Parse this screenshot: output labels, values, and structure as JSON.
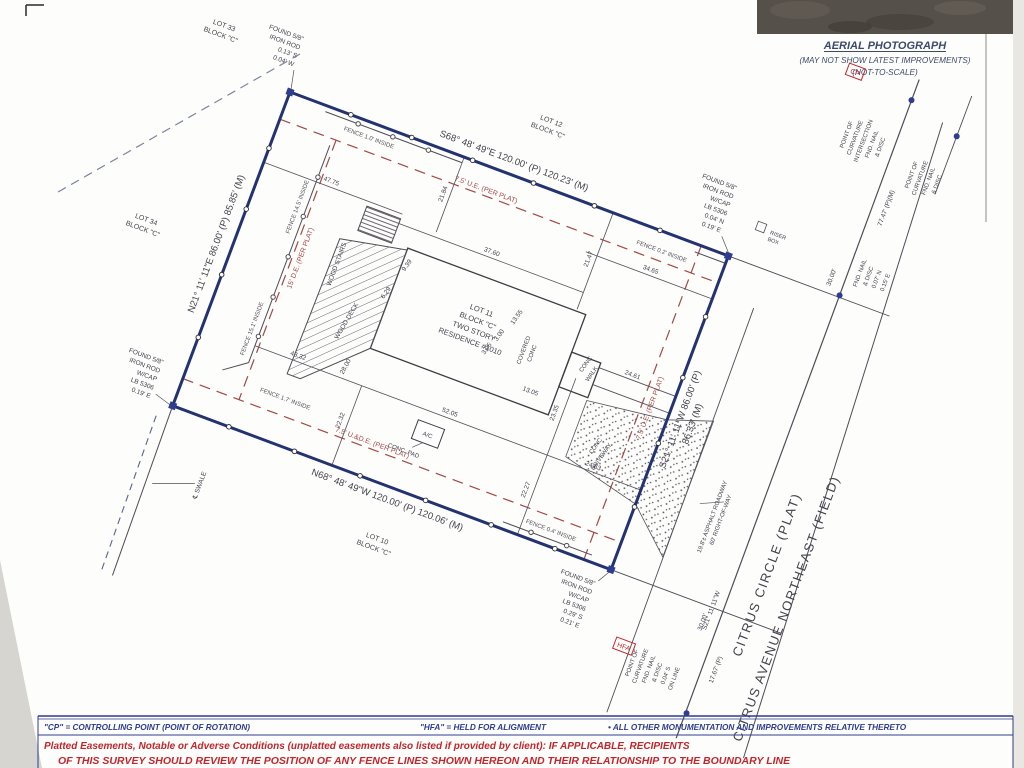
{
  "aerial": {
    "title": "AERIAL PHOTOGRAPH",
    "sub1": "(MAY NOT SHOW LATEST IMPROVEMENTS)",
    "sub2": "(NOT-TO-SCALE)"
  },
  "notes": {
    "l1a": "\"CP\" = CONTROLLING POINT (POINT OF ROTATION)",
    "l1b": "\"HFA\" = HELD FOR ALIGNMENT",
    "l1c": "•    ALL OTHER MONUMENTATION AND IMPROVEMENTS RELATIVE THERETO",
    "l2": "Platted Easements, Notable or Adverse Conditions (unplatted easements also listed if provided by client): IF APPLICABLE, RECIPIENTS",
    "l3": "OF THIS SURVEY SHOULD REVIEW THE POSITION OF ANY FENCE LINES SHOWN HEREON AND THEIR RELATIONSHIP TO THE BOUNDARY LINE"
  },
  "bearings": {
    "north": "S68° 48' 49\"E   120.00' (P) 120.23' (M)",
    "south": "N68° 48' 49\"W   120.00' (P) 120.06' (M)",
    "west": "N21° 11' 11\"E   86.00' (P) 85.85' (M)",
    "east_p": "S21° 11' 11\"W   86.00' (P)",
    "east_m": "86.33' (M)",
    "road": "S21° 11' 11\"W"
  },
  "lots": {
    "lot11_1": "LOT 11",
    "lot11_2": "BLOCK \"C\"",
    "lot11_3": "TWO STORY",
    "lot11_4": "RESIDENCE #1010",
    "lot12_1": "LOT 12",
    "lot12_2": "BLOCK \"C\"",
    "lot33_1": "LOT 33",
    "lot33_2": "BLOCK \"C\"",
    "lot34_1": "LOT 34",
    "lot34_2": "BLOCK \"C\"",
    "lot10_1": "LOT 10",
    "lot10_2": "BLOCK \"C\""
  },
  "streets": {
    "s1": "CITRUS CIRCLE (PLAT)",
    "s2": "CITRUS AVENUE NORTHEAST (FIELD)",
    "asphalt": "19.8'± ASPHALT ROADWAY",
    "row": "60' RIGHT-OF-WAY"
  },
  "easements": {
    "top": "7.5' U.E. (PER PLAT)",
    "left": "15' D.E. (PER PLAT)",
    "right": "7.5' U.E. (PER PLAT)",
    "bottom": "7.5' U.&D.E. (PER PLAT)"
  },
  "fences": {
    "f1": "FENCE 1.0' INSIDE",
    "f2": "FENCE 14.5' INSIDE",
    "f3": "FENCE 15.1' INSIDE",
    "f4": "FENCE 1.7' INSIDE",
    "f5": "FENCE 0.2' INSIDE",
    "f6": "FENCE 0.4' INSIDE"
  },
  "features": {
    "wood_deck": "WOOD DECK",
    "wood_stairs": "WOOD STAIRS",
    "covered1": "COVERED",
    "covered2": "CONC",
    "walk1": "CONC",
    "walk2": "WALK",
    "drive1": "CONC",
    "drive2": "DRIVEWAY",
    "ac": "A/C",
    "conc_pad": "CONC. PAD",
    "swale": "℄ SWALE",
    "riser1": "RISER",
    "riser2": "BOX"
  },
  "flags": {
    "cp": "CP",
    "hfa": "HFA"
  },
  "monuments": {
    "tl": [
      "FOUND 5/8\"",
      "IRON ROD",
      "0.13' S",
      "0.04' W"
    ],
    "tr": [
      "FOUND 5/8\"",
      "IRON ROD",
      "W/CAP",
      "LB 5306",
      "0.04' N",
      "0.19' E"
    ],
    "bl": [
      "FOUND 5/8\"",
      "IRON ROD",
      "W/CAP",
      "LB 5306",
      "0.19' E"
    ],
    "br": [
      "FOUND 5/8\"",
      "IRON ROD",
      "W/CAP",
      "LB 5306",
      "0.29' S",
      "0.21' E"
    ],
    "nail_top": [
      "FND. NAIL",
      "& DISC",
      "0.07' N",
      "0.15' E"
    ],
    "pci": [
      "POINT OF",
      "CURVATURE",
      "INTERSECTION",
      "FND. NAIL",
      "& DISC"
    ],
    "pc_top": [
      "POINT OF",
      "CURVATURE",
      "FND. NAIL",
      "& DISC"
    ],
    "pc_bot": [
      "POINT OF",
      "CURVATURE",
      "FND. NAIL",
      "& DISC",
      "0.04' S",
      "ON LINE"
    ]
  },
  "dims": {
    "d1": "47.75",
    "d2": "21.84",
    "d3": "37.60",
    "d4": "21.47",
    "d5": "9.39",
    "d6": "6.29",
    "d7": "28.00",
    "d8": "43.32",
    "d9": "22.32",
    "d10": "52.05",
    "d11": "23.35",
    "d12": "22.27",
    "d13": "24.63",
    "d14": "24.61",
    "d15": "34.65",
    "d16": "13.55",
    "d17": "3.00",
    "d18": "3.05",
    "d19": "13.05",
    "d20": "30.00'",
    "d21": "30.00'",
    "d22": "77.47' (P)(M)",
    "d23": "17.67' (P)"
  },
  "colors": {
    "boundary": "#233271",
    "linework": "#4f4b55",
    "easement_red": "#a34844",
    "note_red": "#c1262c",
    "note_blue": "#2e3d8f"
  }
}
